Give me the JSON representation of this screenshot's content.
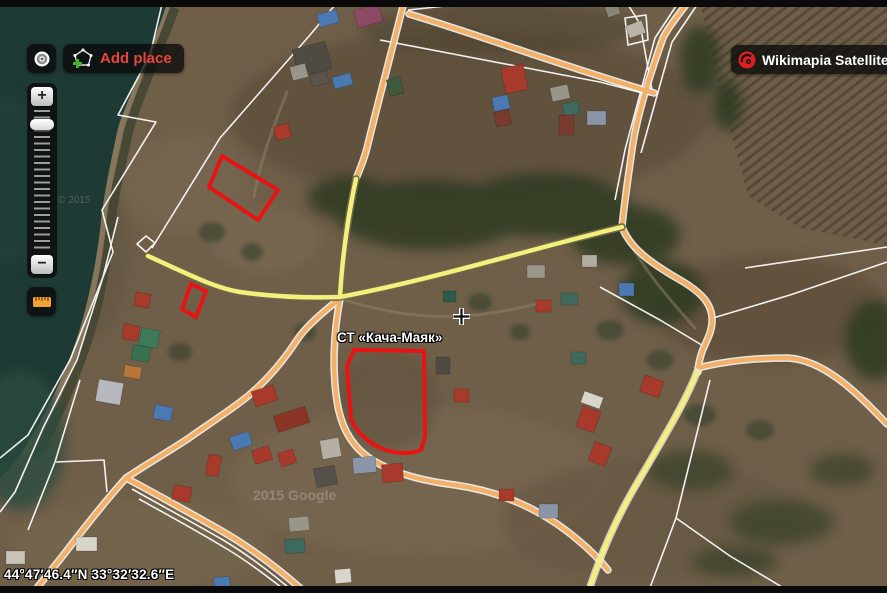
{
  "header": {
    "add_place_label": "Add place",
    "layer_button_label": "Wikimapia Satellite"
  },
  "zoom_control": {
    "zoom_in": "+",
    "zoom_out": "−"
  },
  "map": {
    "place_label": "СТ «Кача-Маяк»",
    "coordinates": "44°47′46.4″N 33°32′32.6″E",
    "watermark": "2015 Google",
    "watermark_secondary": "© 2015",
    "icons": {
      "locate": "crosshair-circle-icon",
      "add_place": "pentagon-plus-icon",
      "layers": "wikimapia-logo-icon",
      "ruler": "ruler-icon",
      "cursor": "crosshair-cursor"
    },
    "colors": {
      "parcel_outline": "#e81313",
      "road_major_yellow": "#f5ef7d",
      "road_minor_orange": "#f2b068",
      "accent_red": "#e8453c",
      "water": "#1e3a34"
    }
  }
}
